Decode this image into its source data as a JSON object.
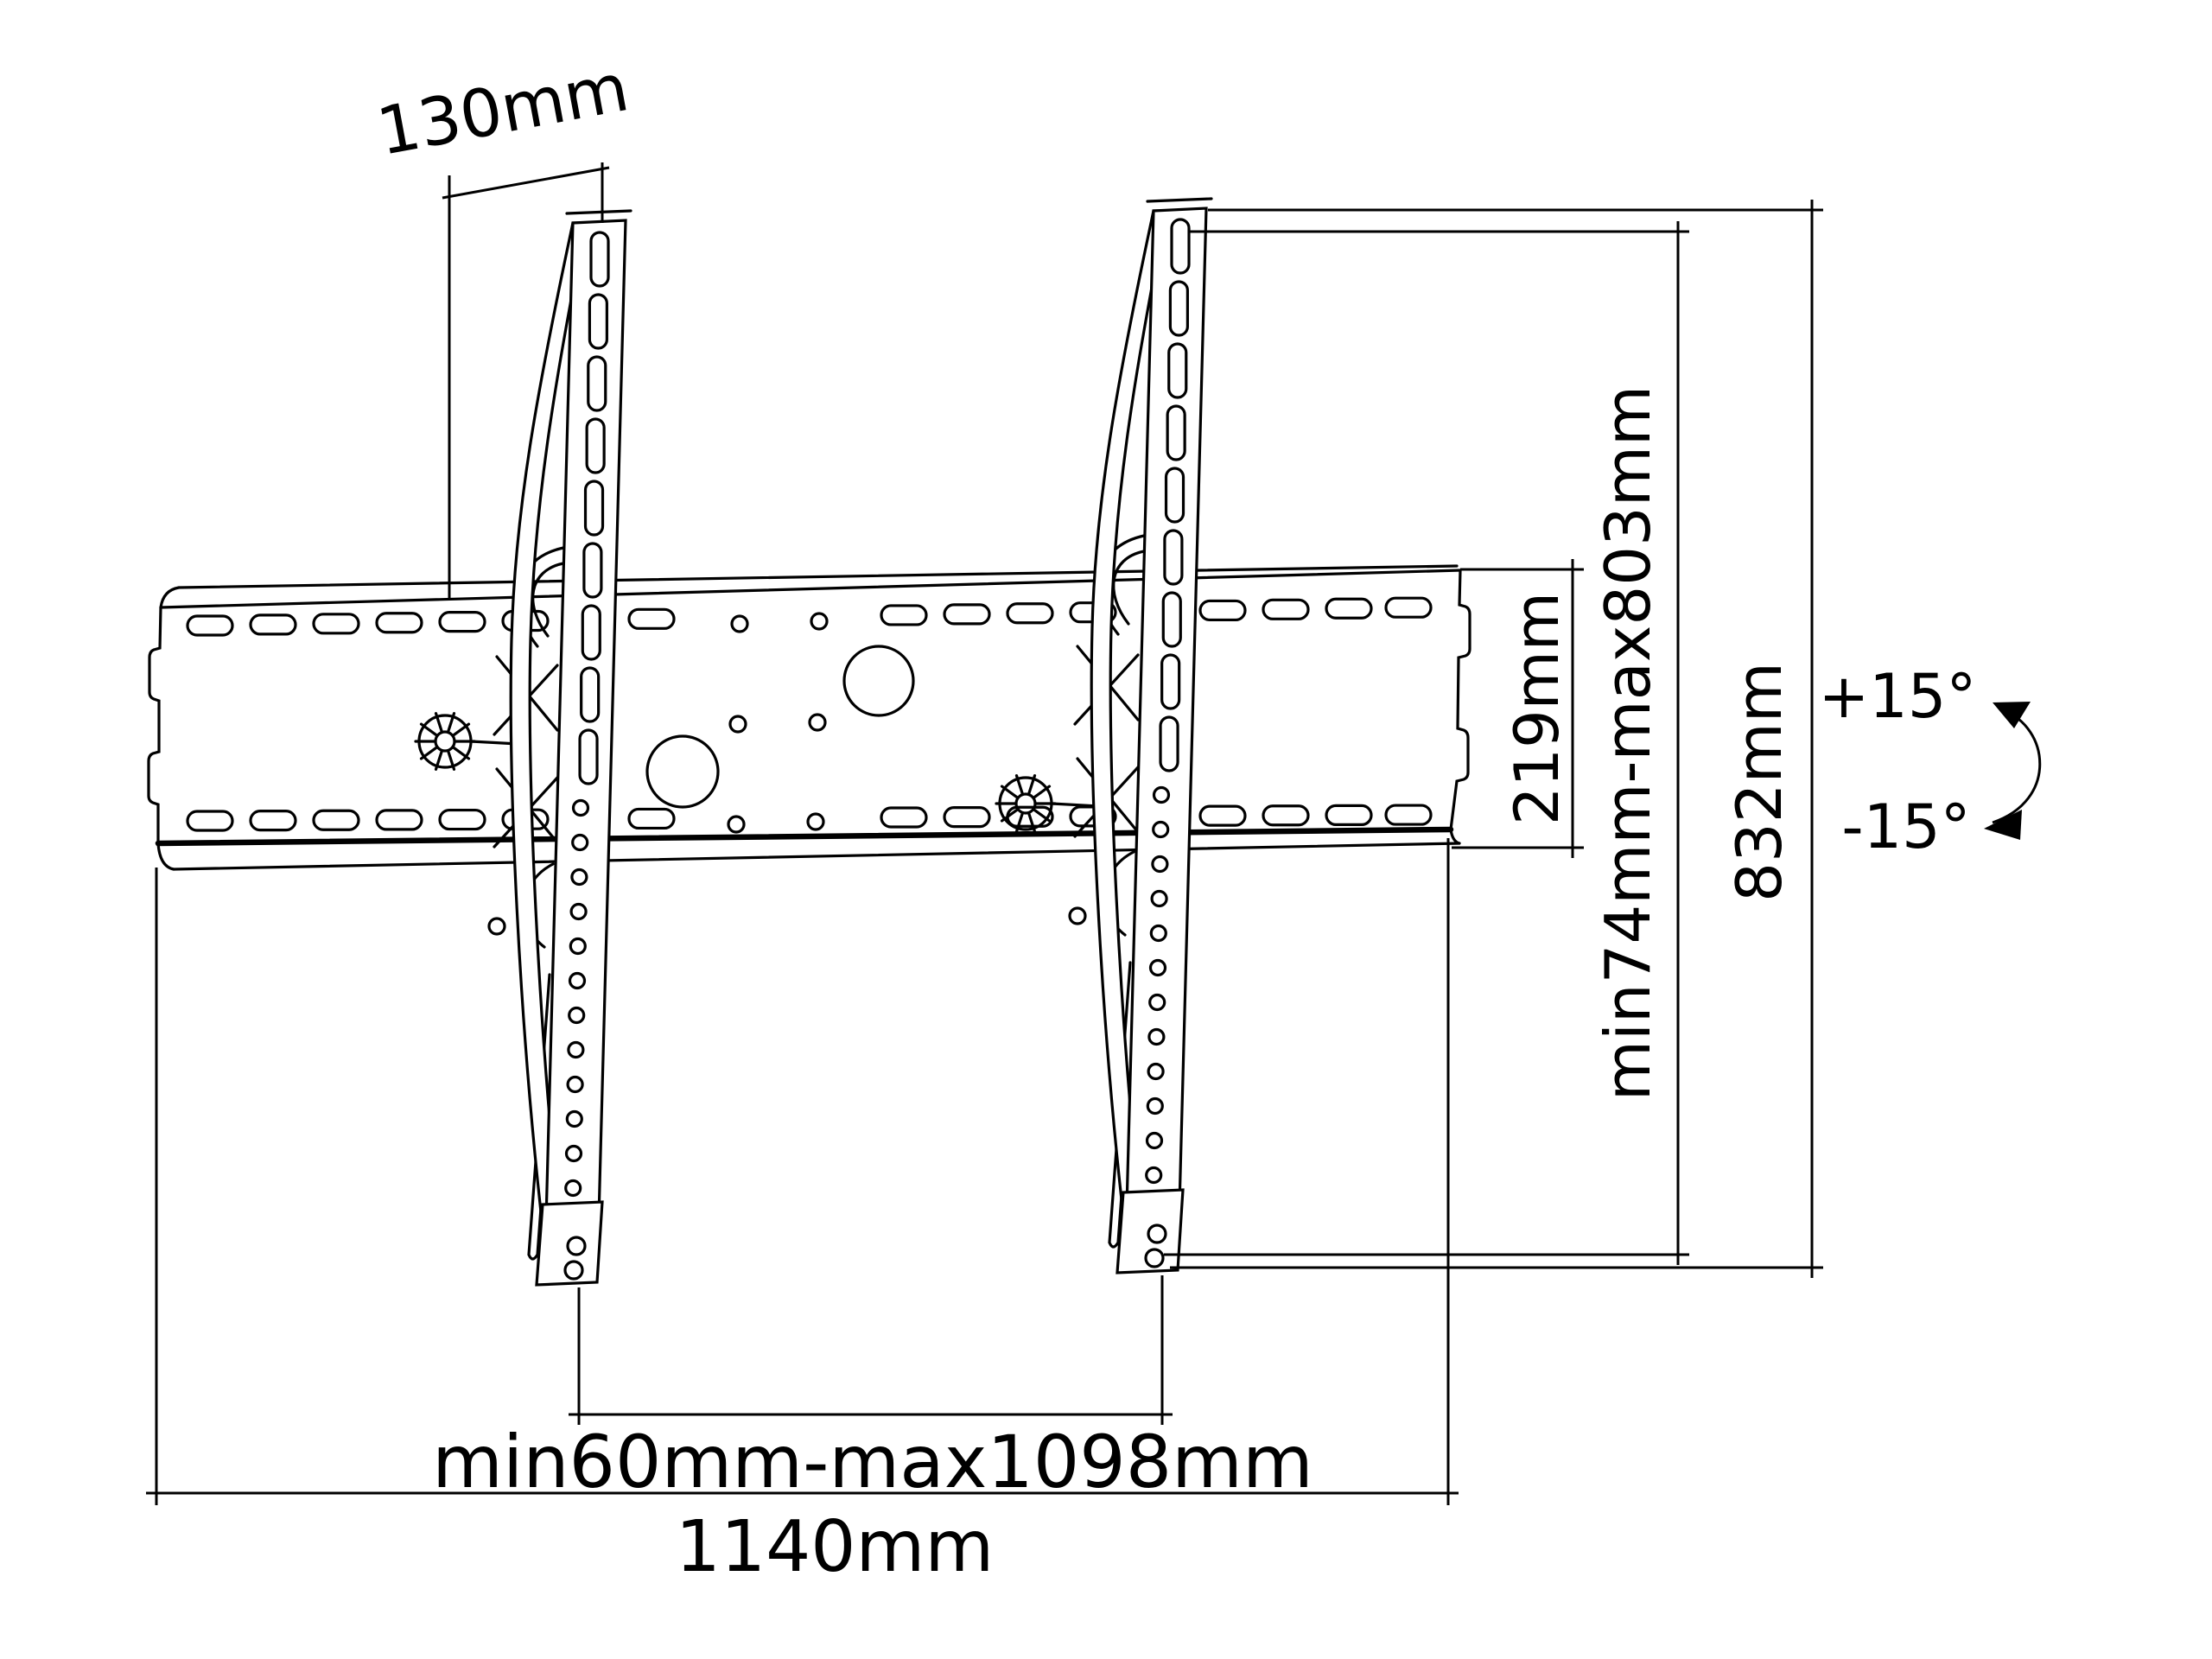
{
  "drawing": {
    "type": "tilting-tv-wall-mount-dimension-diagram",
    "colors": {
      "line": "#000000",
      "background": "#ffffff"
    },
    "dimensions": {
      "bracket_depth": {
        "label": "130mm"
      },
      "plate_height": {
        "label": "219mm"
      },
      "vesa_vertical_range": {
        "label": "min74mm-max803mm"
      },
      "total_height": {
        "label": "832mm"
      },
      "tilt_up": {
        "label": "+15°"
      },
      "tilt_down": {
        "label": "-15°"
      },
      "vesa_horizontal_range": {
        "label": "min60mm-max1098mm"
      },
      "total_width": {
        "label": "1140mm"
      }
    }
  }
}
